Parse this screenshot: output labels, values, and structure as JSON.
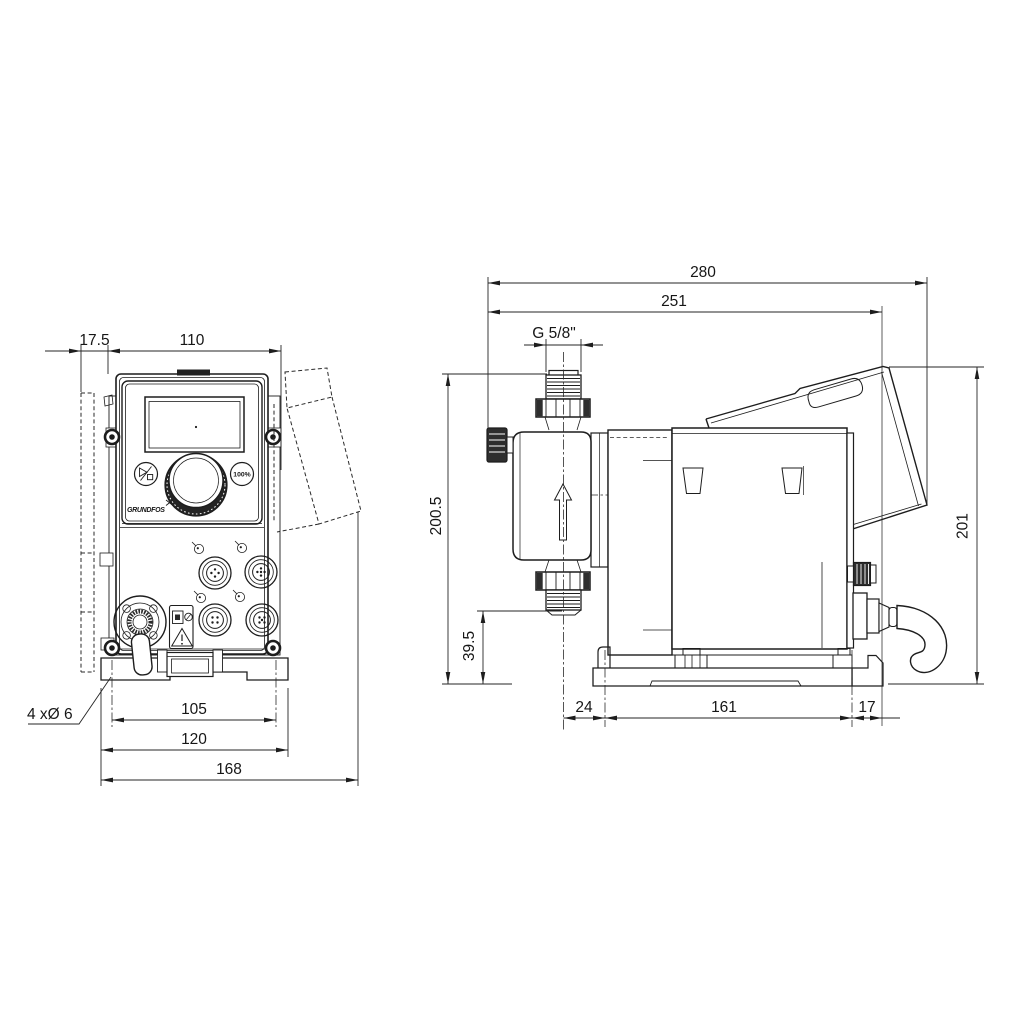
{
  "drawing": {
    "background": "#ffffff",
    "line_color": "#1d1d1d",
    "units_implied": "mm",
    "front_view": {
      "dims": {
        "plate_offset": "17.5",
        "body_width": "110",
        "hole_span": "105",
        "plate_width": "120",
        "overall_width": "168"
      },
      "holes_label": "4 xØ 6",
      "panel": {
        "logo": "GRUNDFOS",
        "capacity_button": "100%"
      }
    },
    "side_view": {
      "dims": {
        "overall_depth": "280",
        "depth_to_bracket": "251",
        "connection_thread": "G 5/8\"",
        "total_height": "200.5",
        "valve_height": "39.5",
        "base_front_offset": "24",
        "base_length": "161",
        "base_rear_offset": "17",
        "rear_height": "201"
      }
    }
  }
}
